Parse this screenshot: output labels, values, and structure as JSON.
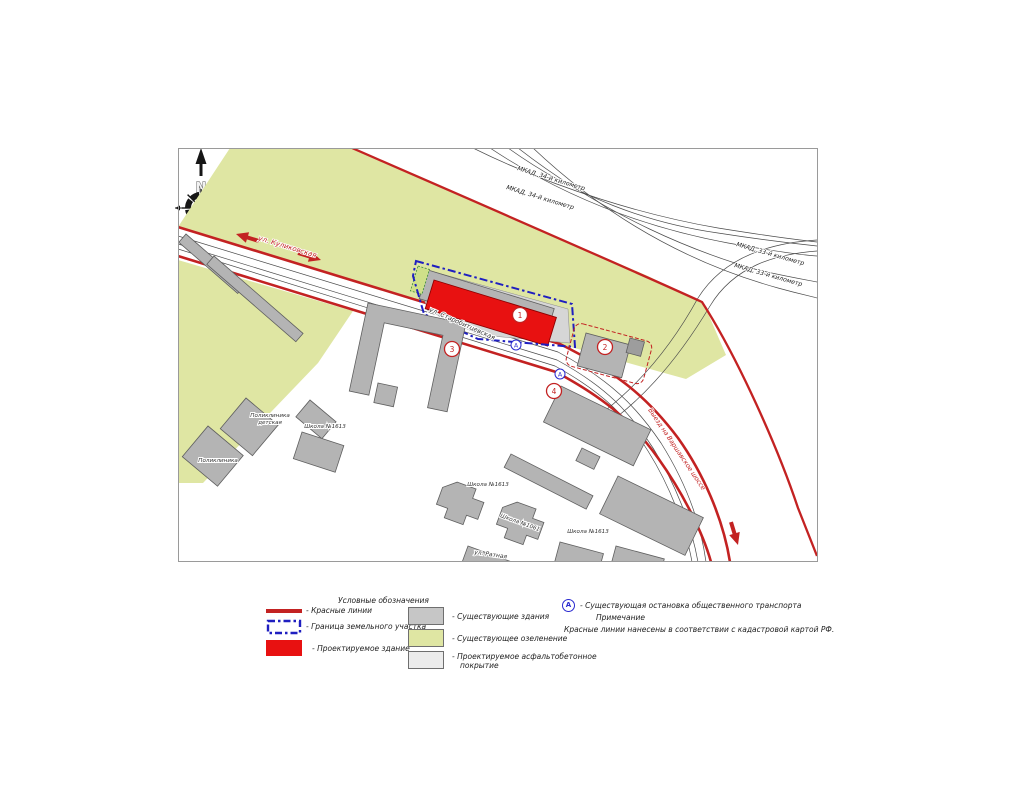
{
  "compass": {
    "north": "N"
  },
  "map": {
    "streets": {
      "kulikovskaya": "ул. Куликовская",
      "starobittsevskaya": "ул. Старобитцевская",
      "ratnaya": "ул. Ратная",
      "varshavskoe_exit": "Выезд на Варшавское шоссе"
    },
    "mkad": {
      "km34_a": "МКАД, 34-й километр",
      "km34_b": "МКАД, 34-й километр",
      "km33_a": "МКАД, 33-й километр",
      "km33_b": "МКАД, 33-й километр"
    },
    "buildings": {
      "polyclinic_children_1": "Поликлиника",
      "polyclinic_children_2": "детская",
      "polyclinic": "Поликлиника",
      "school_1613_west": "Школа №1613",
      "school_1613_center": "Школа №1613",
      "school_1061": "Школа №1061",
      "school_1613_east": "Школа №1613"
    },
    "markers": {
      "n1": "1",
      "n2": "2",
      "n3": "3",
      "n4": "4",
      "bus": "А"
    }
  },
  "legend": {
    "title": "Условные обозначения",
    "red_lines": "- Красные линии",
    "plot_boundary": "- Граница земельного участка",
    "projected_building": "- Проектируемое здание",
    "existing_buildings": "- Существующие здания",
    "existing_greenery": "- Существующее озеленение",
    "projected_pavement_1": "- Проектируемое асфальтобетонное",
    "projected_pavement_2": "покрытие",
    "bus_stop_marker": "А",
    "bus_stop": "- Существующая остановка общественного транспорта",
    "note_title": "Примечание",
    "note_text": "Красные линии нанесены в соответствии с кадастровой картой РФ."
  },
  "colors": {
    "red_line": "#c32222",
    "projected_building_fill": "#e81111",
    "plot_boundary_blue": "#1f1fc0",
    "greenery": "#dfe6a3",
    "existing_building_fill": "#b4b4b4",
    "pavement": "#ececec"
  }
}
